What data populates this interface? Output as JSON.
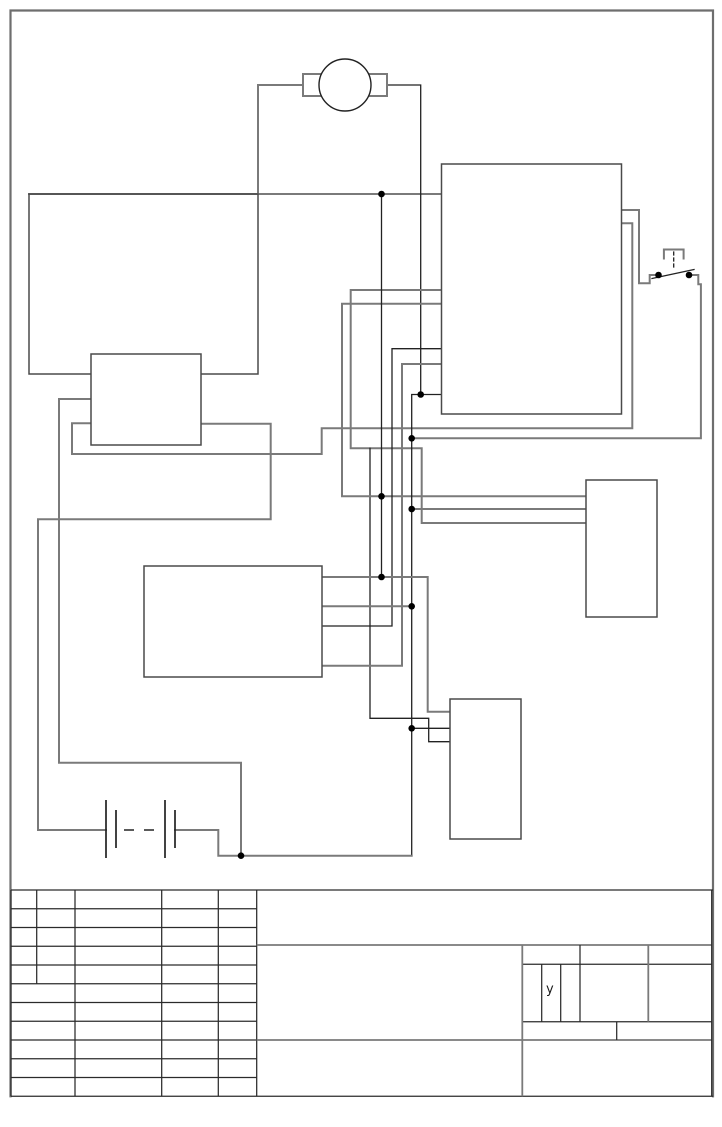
{
  "page": {
    "width": 722,
    "height": 1127,
    "background": "#ffffff"
  },
  "colors": {
    "gray_wire": "#7a7a7a",
    "black_wire": "#222222",
    "title_line": "#2b2b2b",
    "box_stroke": "#4a4a4a",
    "junction_dot": "#000000"
  },
  "styles": {
    "g": {
      "color": "#7a7a7a",
      "w": 2
    },
    "k": {
      "color": "#222222",
      "w": 1.3
    },
    "t": {
      "color": "#2b2b2b",
      "w": 1.25
    },
    "tg": {
      "color": "#7a7a7a",
      "w": 1.8
    },
    "box": {
      "color": "#4a4a4a",
      "w": 1.5
    },
    "frame": {
      "color": "#6e6e6e",
      "w": 2.2
    }
  },
  "frame": {
    "name": "drawing-frame",
    "points": [
      [
        10.5,
        1096.3
      ],
      [
        10.5,
        10.5
      ],
      [
        713,
        10.5
      ],
      [
        713,
        1096.3
      ]
    ]
  },
  "diagram": {
    "motor": {
      "name": "motor-symbol",
      "circle": {
        "cx": 345,
        "cy": 85,
        "r": 26,
        "cls": "k"
      },
      "terminals": [
        {
          "name": "motor-terminal-left",
          "x": 303,
          "y": 74,
          "w": 20,
          "h": 22,
          "cls": "g"
        },
        {
          "name": "motor-terminal-right",
          "x": 367,
          "y": 74,
          "w": 20,
          "h": 22,
          "cls": "g"
        }
      ]
    },
    "boxes": [
      {
        "name": "component-box-top-left",
        "x": 29,
        "y": 194,
        "w": 229,
        "h": 180,
        "cls": "box"
      },
      {
        "name": "component-box-small-left",
        "x": 91,
        "y": 354,
        "w": 110,
        "h": 91,
        "cls": "box",
        "fill": "#ffffff"
      },
      {
        "name": "component-box-top-right",
        "x": 441.5,
        "y": 164,
        "w": 180,
        "h": 250,
        "cls": "box",
        "fill": "#ffffff"
      },
      {
        "name": "component-box-mid-right",
        "x": 586,
        "y": 480,
        "w": 71,
        "h": 137,
        "cls": "box",
        "fill": "#ffffff"
      },
      {
        "name": "component-box-center",
        "x": 144,
        "y": 566,
        "w": 178,
        "h": 111,
        "cls": "box",
        "fill": "#ffffff"
      },
      {
        "name": "component-box-bottom-right",
        "x": 450,
        "y": 699,
        "w": 71,
        "h": 140,
        "cls": "box",
        "fill": "#ffffff"
      }
    ],
    "wires": [
      {
        "name": "wire-motor-left",
        "cls": "g",
        "points": [
          [
            303,
            85
          ],
          [
            258,
            85
          ],
          [
            258,
            194
          ]
        ]
      },
      {
        "name": "wire-top-bus",
        "cls": "g",
        "points": [
          [
            29,
            194
          ],
          [
            441.5,
            194
          ]
        ]
      },
      {
        "name": "wire-motor-right",
        "cls": "k",
        "points": [
          [
            387,
            85
          ],
          [
            420.7,
            85
          ],
          [
            420.7,
            394.5
          ]
        ]
      },
      {
        "name": "wire-boxb-to-bigbox-right",
        "cls": "g",
        "points": [
          [
            621.5,
            223.3
          ],
          [
            632.3,
            223.3
          ],
          [
            632.3,
            428.3
          ],
          [
            321.7,
            428.3
          ],
          [
            321.7,
            454
          ],
          [
            72,
            454
          ],
          [
            72,
            423.3
          ],
          [
            91,
            423.3
          ]
        ]
      },
      {
        "name": "wire-bigbox-to-midright-upper",
        "cls": "g",
        "points": [
          [
            441.5,
            290
          ],
          [
            350.7,
            290
          ],
          [
            350.7,
            448.3
          ],
          [
            421.7,
            448.3
          ],
          [
            421.7,
            523
          ],
          [
            586,
            523
          ]
        ]
      },
      {
        "name": "wire-drop-to-bottomright-3",
        "cls": "k",
        "points": [
          [
            370,
            448.3
          ],
          [
            370,
            718.3
          ],
          [
            428.7,
            718.3
          ],
          [
            428.7,
            741.7
          ],
          [
            450,
            741.7
          ]
        ]
      },
      {
        "name": "wire-bigbox-to-midright-top",
        "cls": "g",
        "points": [
          [
            441.5,
            303.7
          ],
          [
            342,
            303.7
          ],
          [
            342,
            496.3
          ],
          [
            586,
            496.3
          ]
        ]
      },
      {
        "name": "wire-bigbox-to-center-1",
        "cls": "k",
        "points": [
          [
            441.5,
            348.7
          ],
          [
            392,
            348.7
          ],
          [
            392,
            626
          ],
          [
            322,
            626
          ]
        ]
      },
      {
        "name": "wire-bigbox-to-center-2",
        "cls": "g",
        "points": [
          [
            441.5,
            364
          ],
          [
            402,
            364
          ],
          [
            402,
            665.7
          ],
          [
            322,
            665.7
          ]
        ]
      },
      {
        "name": "wire-main-spine",
        "cls": "k",
        "points": [
          [
            441.5,
            394.5
          ],
          [
            411.7,
            394.5
          ],
          [
            411.7,
            855.7
          ]
        ]
      },
      {
        "name": "wire-spine-to-bottomright-2",
        "cls": "k",
        "points": [
          [
            411.7,
            728.3
          ],
          [
            450,
            728.3
          ]
        ]
      },
      {
        "name": "wire-battery-negative",
        "cls": "g",
        "points": [
          [
            175,
            830
          ],
          [
            218.3,
            830
          ],
          [
            218.3,
            855.7
          ],
          [
            411.7,
            855.7
          ]
        ]
      },
      {
        "name": "wire-boxb-left-to-bottom",
        "cls": "g",
        "points": [
          [
            91,
            399
          ],
          [
            59,
            399
          ],
          [
            59,
            762.7
          ],
          [
            241,
            762.7
          ],
          [
            241,
            855.7
          ]
        ]
      },
      {
        "name": "wire-boxb-to-battery-positive",
        "cls": "g",
        "points": [
          [
            201,
            423.7
          ],
          [
            270.7,
            423.7
          ],
          [
            270.7,
            519.3
          ],
          [
            38,
            519.3
          ],
          [
            38,
            830
          ],
          [
            106,
            830
          ]
        ]
      },
      {
        "name": "wire-midright-2",
        "cls": "g",
        "points": [
          [
            586,
            509
          ],
          [
            411.7,
            509
          ]
        ]
      },
      {
        "name": "wire-center-to-bottomright-1",
        "cls": "g",
        "points": [
          [
            322,
            577
          ],
          [
            427.7,
            577
          ],
          [
            427.7,
            711.7
          ],
          [
            450,
            711.7
          ]
        ]
      },
      {
        "name": "wire-center-2",
        "cls": "g",
        "points": [
          [
            322,
            606.3
          ],
          [
            411.7,
            606.3
          ]
        ]
      },
      {
        "name": "wire-vertical-381",
        "cls": "k",
        "points": [
          [
            381.5,
            194
          ],
          [
            381.5,
            577
          ]
        ]
      },
      {
        "name": "wire-switch-left-lead",
        "cls": "g",
        "points": [
          [
            621.5,
            210
          ],
          [
            639,
            210
          ],
          [
            639,
            283.3
          ],
          [
            649.7,
            283.3
          ],
          [
            649.7,
            275
          ],
          [
            655,
            275
          ]
        ]
      },
      {
        "name": "wire-switch-right-lead",
        "cls": "g",
        "points": [
          [
            692.5,
            275
          ],
          [
            698.3,
            275
          ],
          [
            698.3,
            284.3
          ],
          [
            700.9,
            284.3
          ],
          [
            700.9,
            438.3
          ],
          [
            411.7,
            438.3
          ]
        ]
      }
    ],
    "switch": {
      "name": "push-button-switch",
      "blade": {
        "cls": "k",
        "points": [
          [
            652,
            278.5
          ],
          [
            694,
            269.5
          ]
        ]
      },
      "bracket": {
        "cls": "g",
        "points": [
          [
            663.9,
            258.5
          ],
          [
            663.9,
            249.5
          ],
          [
            683.6,
            249.5
          ],
          [
            683.6,
            258.5
          ]
        ]
      },
      "plunger": {
        "cls": "k",
        "dash": "3,3",
        "points": [
          [
            673.7,
            252
          ],
          [
            673.7,
            269
          ]
        ]
      }
    },
    "battery": {
      "name": "battery-symbol",
      "plates": [
        {
          "name": "battery-plate-long-1",
          "x1": 106,
          "y1": 800,
          "x2": 106,
          "y2": 858,
          "cls": "k",
          "w": 1.7
        },
        {
          "name": "battery-plate-short-1",
          "x1": 116,
          "y1": 810,
          "x2": 116,
          "y2": 848,
          "cls": "k",
          "w": 1.7
        },
        {
          "name": "battery-plate-long-2",
          "x1": 165,
          "y1": 800,
          "x2": 165,
          "y2": 858,
          "cls": "k",
          "w": 1.7
        },
        {
          "name": "battery-plate-short-2",
          "x1": 175,
          "y1": 810,
          "x2": 175,
          "y2": 848,
          "cls": "k",
          "w": 1.7
        }
      ],
      "dashes": [
        {
          "x1": 124,
          "y1": 830,
          "x2": 134,
          "y2": 830,
          "cls": "k"
        },
        {
          "x1": 144,
          "y1": 830,
          "x2": 154,
          "y2": 830,
          "cls": "k"
        }
      ]
    },
    "junction_dots": {
      "r": 3.3,
      "points": [
        [
          381.5,
          194
        ],
        [
          420.7,
          394.5
        ],
        [
          411.7,
          438.3
        ],
        [
          381.5,
          496.3
        ],
        [
          411.7,
          509
        ],
        [
          381.5,
          577
        ],
        [
          411.7,
          606.3
        ],
        [
          411.7,
          728.3
        ],
        [
          241,
          855.7
        ],
        [
          658.5,
          275
        ],
        [
          689,
          275
        ]
      ]
    }
  },
  "title_block": {
    "lines": [
      {
        "name": "tb-top",
        "x1": 11,
        "y1": 890,
        "x2": 713,
        "y2": 890,
        "cls": "t"
      },
      {
        "name": "tb-row",
        "x1": 11,
        "y1": 908.8,
        "x2": 256.7,
        "y2": 908.8,
        "cls": "t"
      },
      {
        "name": "tb-row",
        "x1": 11,
        "y1": 927.5,
        "x2": 256.7,
        "y2": 927.5,
        "cls": "t"
      },
      {
        "name": "tb-row",
        "x1": 11,
        "y1": 946.3,
        "x2": 256.7,
        "y2": 946.3,
        "cls": "t"
      },
      {
        "name": "tb-row",
        "x1": 11,
        "y1": 965,
        "x2": 256.7,
        "y2": 965,
        "cls": "t"
      },
      {
        "name": "tb-row",
        "x1": 11,
        "y1": 983.8,
        "x2": 256.7,
        "y2": 983.8,
        "cls": "t"
      },
      {
        "name": "tb-row",
        "x1": 11,
        "y1": 1002.5,
        "x2": 256.7,
        "y2": 1002.5,
        "cls": "t"
      },
      {
        "name": "tb-row",
        "x1": 11,
        "y1": 1021.3,
        "x2": 256.7,
        "y2": 1021.3,
        "cls": "t"
      },
      {
        "name": "tb-row",
        "x1": 11,
        "y1": 1040,
        "x2": 256.7,
        "y2": 1040,
        "cls": "t"
      },
      {
        "name": "tb-row",
        "x1": 11,
        "y1": 1058.8,
        "x2": 256.7,
        "y2": 1058.8,
        "cls": "t"
      },
      {
        "name": "tb-row",
        "x1": 11,
        "y1": 1077.5,
        "x2": 256.7,
        "y2": 1077.5,
        "cls": "t"
      },
      {
        "name": "tb-bottom",
        "x1": 11,
        "y1": 1096.3,
        "x2": 713,
        "y2": 1096.3,
        "cls": "t"
      },
      {
        "name": "tb-col",
        "x1": 11,
        "y1": 890,
        "x2": 11,
        "y2": 1096.3,
        "cls": "t"
      },
      {
        "name": "tb-col-sub",
        "x1": 36.7,
        "y1": 890,
        "x2": 36.7,
        "y2": 983.8,
        "cls": "t"
      },
      {
        "name": "tb-col",
        "x1": 75,
        "y1": 890,
        "x2": 75,
        "y2": 1096.3,
        "cls": "t"
      },
      {
        "name": "tb-col",
        "x1": 161.7,
        "y1": 890,
        "x2": 161.7,
        "y2": 1096.3,
        "cls": "t"
      },
      {
        "name": "tb-col",
        "x1": 218.3,
        "y1": 890,
        "x2": 218.3,
        "y2": 1096.3,
        "cls": "t"
      },
      {
        "name": "tb-col",
        "x1": 256.7,
        "y1": 890,
        "x2": 256.7,
        "y2": 1096.3,
        "cls": "t"
      },
      {
        "name": "tb-mid-line",
        "x1": 256.7,
        "y1": 945,
        "x2": 711.7,
        "y2": 945,
        "cls": "tg"
      },
      {
        "name": "tb-mid-line",
        "x1": 256.7,
        "y1": 1040,
        "x2": 711.7,
        "y2": 1040,
        "cls": "tg"
      },
      {
        "name": "tb-right-row",
        "x1": 522.3,
        "y1": 964.3,
        "x2": 711.7,
        "y2": 964.3,
        "cls": "t"
      },
      {
        "name": "tb-right-row",
        "x1": 522.3,
        "y1": 1021.7,
        "x2": 711.7,
        "y2": 1021.7,
        "cls": "t"
      },
      {
        "name": "tb-right-col",
        "x1": 522.3,
        "y1": 945,
        "x2": 522.3,
        "y2": 1096.3,
        "cls": "tg"
      },
      {
        "name": "tb-right-col",
        "x1": 580,
        "y1": 945,
        "x2": 580,
        "y2": 1021.7,
        "cls": "t"
      },
      {
        "name": "tb-right-col",
        "x1": 648.3,
        "y1": 945,
        "x2": 648.3,
        "y2": 1021.7,
        "cls": "tg"
      },
      {
        "name": "tb-right-col",
        "x1": 616.7,
        "y1": 1021.7,
        "x2": 616.7,
        "y2": 1040,
        "cls": "t"
      },
      {
        "name": "tb-right-col",
        "x1": 711.7,
        "y1": 890,
        "x2": 711.7,
        "y2": 1096.3,
        "cls": "t"
      },
      {
        "name": "tb-ycell-col",
        "x1": 541.7,
        "y1": 964.3,
        "x2": 541.7,
        "y2": 1021.7,
        "cls": "t"
      },
      {
        "name": "tb-ycell-col",
        "x1": 560.7,
        "y1": 964.3,
        "x2": 560.7,
        "y2": 1021.7,
        "cls": "t"
      }
    ],
    "label": {
      "text": "y",
      "x": 546,
      "y": 983
    }
  }
}
